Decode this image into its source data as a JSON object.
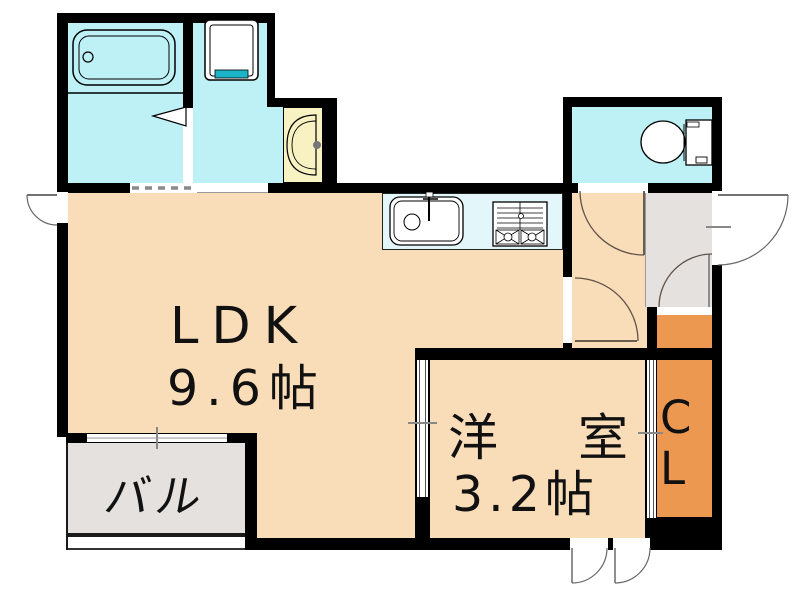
{
  "floorplan": {
    "rooms": {
      "ldk": {
        "label": "LDK",
        "size": "9.6帖"
      },
      "western_room": {
        "label": "洋室",
        "size": "3.2帖"
      },
      "closet": {
        "label": "CL"
      },
      "balcony": {
        "label": "バル"
      }
    },
    "fixtures": [
      "bathtub",
      "washing-machine-pan",
      "washbasin",
      "toilet",
      "kitchen-sink",
      "gas-stove",
      "entry-door",
      "balcony-window"
    ],
    "colors": {
      "wall": "#000000",
      "room_floor": "#f9dcb8",
      "closet_floor": "#ec9851",
      "sanitary_floor": "#bdf1f6",
      "kitchen_counter": "#e3f6fa",
      "washbasin": "#f8f2c2",
      "balcony_entry_floor": "#e4e1de",
      "washer_pan_accent": "#1cb5c8"
    }
  }
}
